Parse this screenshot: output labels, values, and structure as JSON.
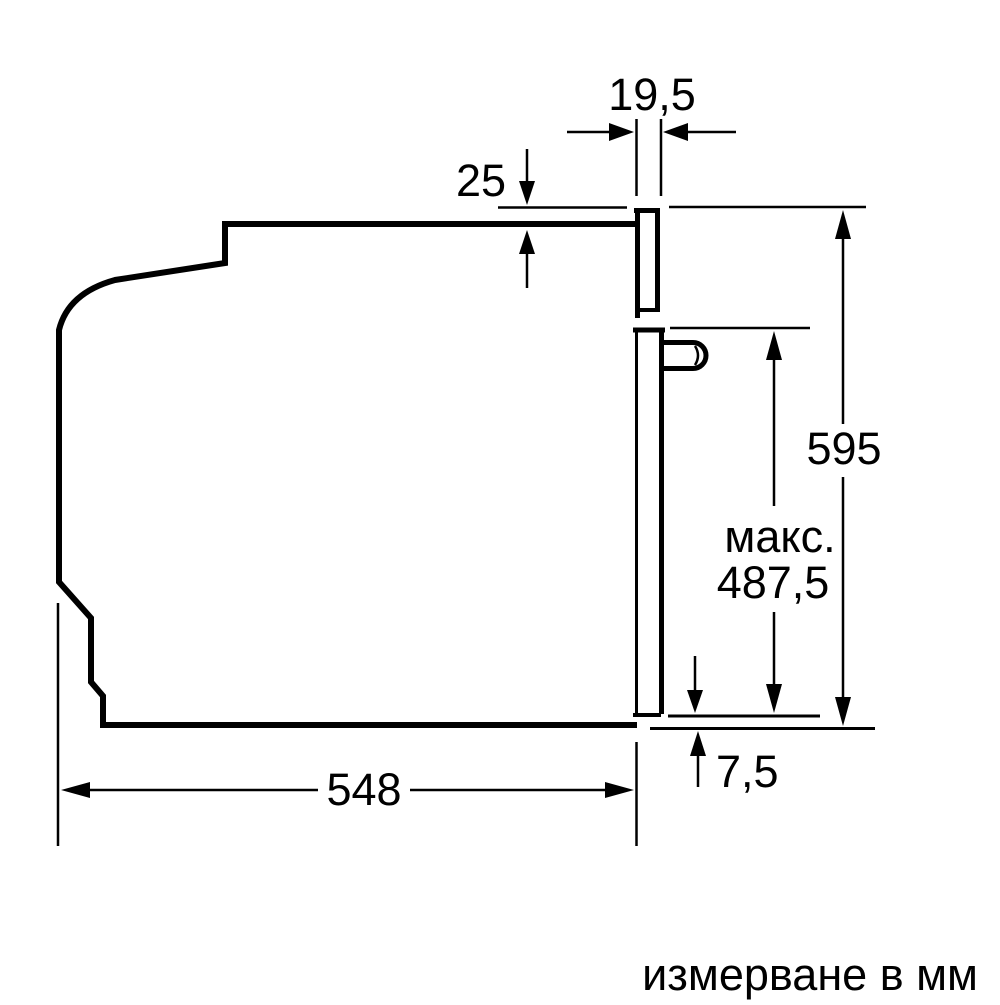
{
  "diagram": {
    "unit_note": "измерване в мм",
    "dimensions": {
      "door_panel_thickness": "19,5",
      "top_clearance": "25",
      "appliance_height": "595",
      "max_prefix": "макс.",
      "max_value": "487,5",
      "bottom_offset": "7,5",
      "appliance_depth": "548"
    },
    "line_color": "#000000",
    "background_color": "#ffffff"
  }
}
